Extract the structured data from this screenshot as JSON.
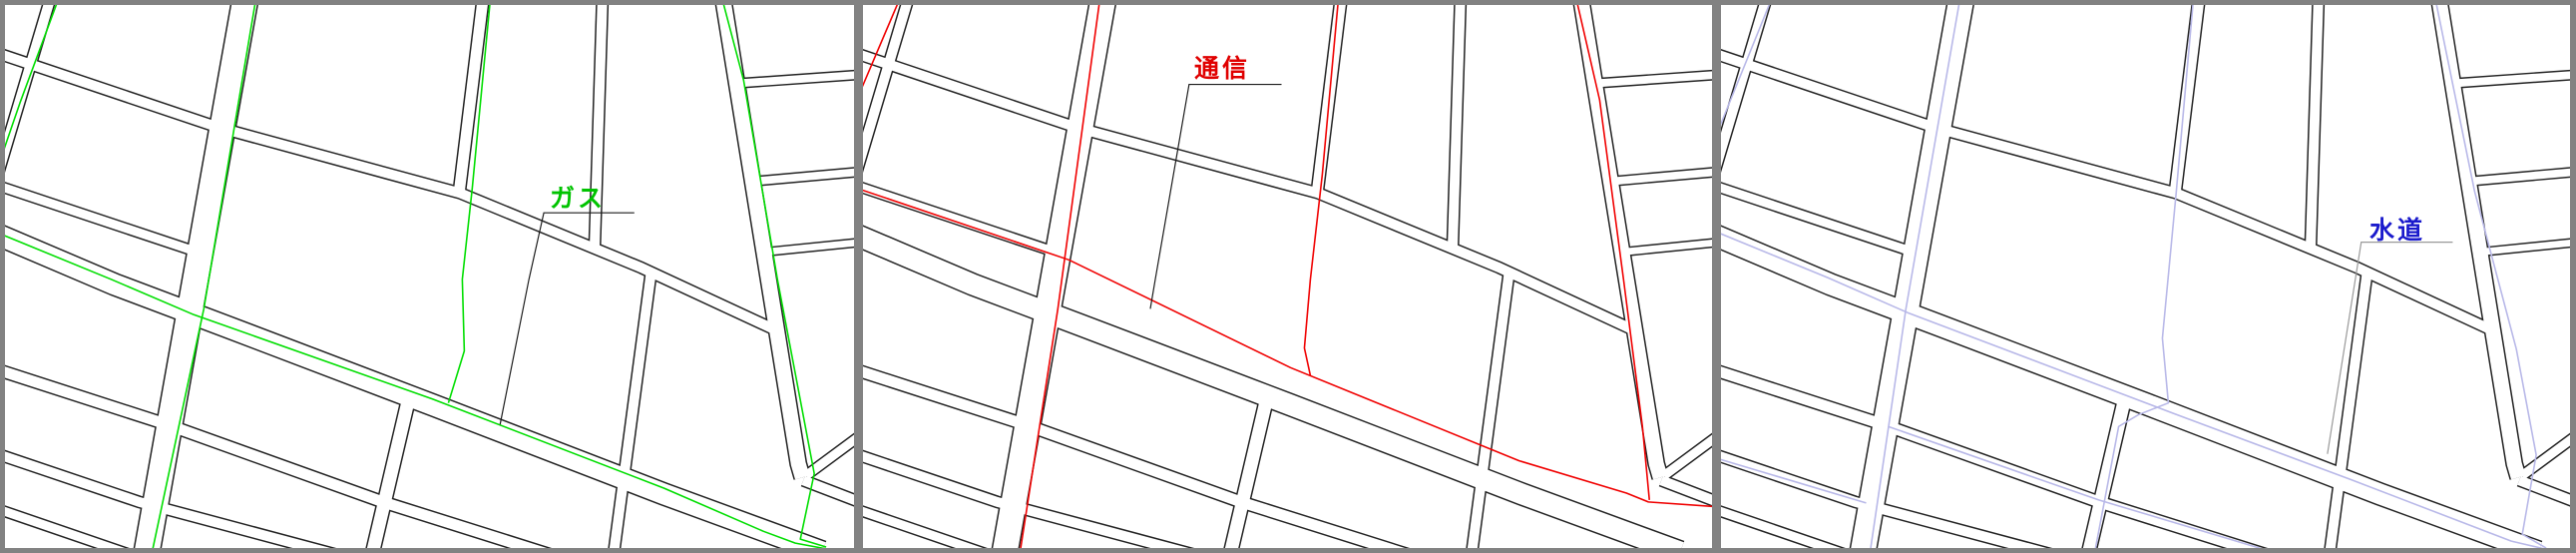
{
  "window": {
    "title": "utility-map-views",
    "frame_color": "#828282",
    "map_background": "#ffffff",
    "street_outline_color": "#222222"
  },
  "panels": [
    {
      "id": "gas",
      "label": "ガス",
      "utility": "gas-lines",
      "line_color": "#00DE00",
      "label_color": "#00C300",
      "leader_color": "#1c1c1c"
    },
    {
      "id": "telecom",
      "label": "通信",
      "utility": "telecom-lines",
      "line_color": "#F00000",
      "label_color": "#E00000",
      "leader_color": "#1c1c1c"
    },
    {
      "id": "water",
      "label": "水道",
      "utility": "water-lines",
      "line_color": "#B8B8E8",
      "label_color": "#1A1ACC",
      "leader_color": "#999999"
    }
  ]
}
